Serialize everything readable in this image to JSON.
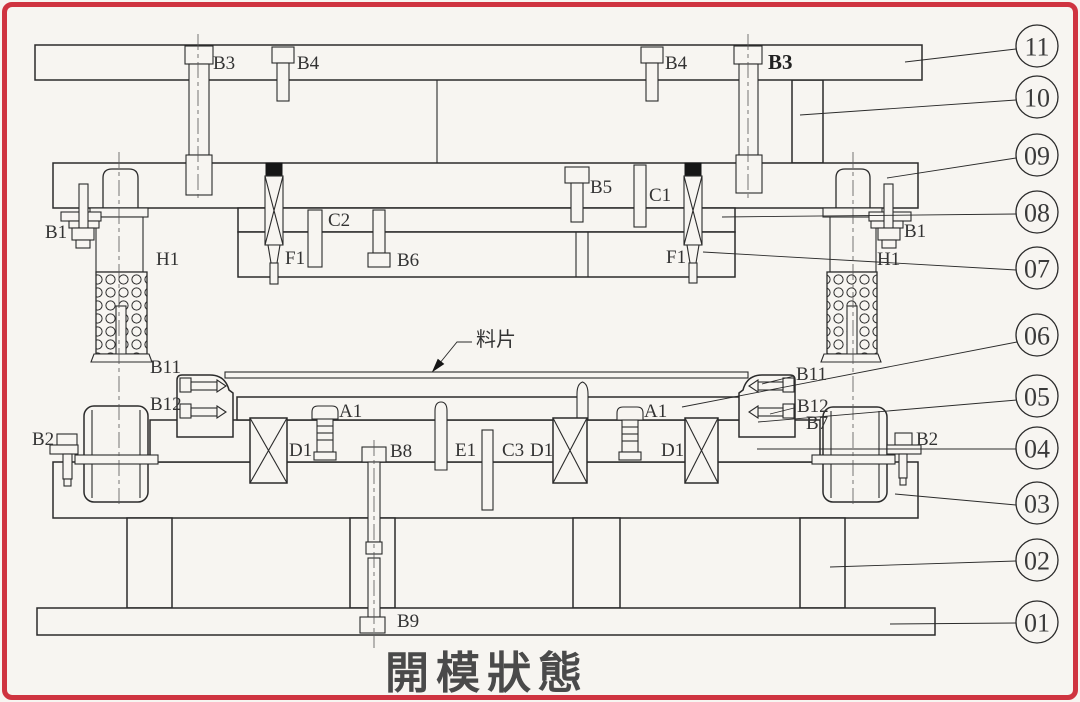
{
  "title": "開模狀態",
  "strip_label": "料片",
  "colors": {
    "border": "#cf3440",
    "paper": "#f7f5f1",
    "line": "#2b2b2b"
  },
  "balloons": [
    {
      "num": "11"
    },
    {
      "num": "10"
    },
    {
      "num": "09"
    },
    {
      "num": "08"
    },
    {
      "num": "07"
    },
    {
      "num": "06"
    },
    {
      "num": "05"
    },
    {
      "num": "04"
    },
    {
      "num": "03"
    },
    {
      "num": "02"
    },
    {
      "num": "01"
    }
  ],
  "labels": {
    "b3_left": "B3",
    "b4_left": "B4",
    "b4_right": "B4",
    "b3_right": "B3",
    "b5": "B5",
    "c1": "C1",
    "c2": "C2",
    "b6": "B6",
    "f1_left": "F1",
    "f1_right": "F1",
    "b1_left": "B1",
    "b1_right": "B1",
    "h1_left": "H1",
    "h1_right": "H1",
    "b11_left": "B11",
    "b12_left": "B12",
    "b11_right": "B11",
    "b12_right": "B12",
    "b7": "B7",
    "b2_left": "B2",
    "b2_right": "B2",
    "a1_left": "A1",
    "a1_right": "A1",
    "d1_left": "D1",
    "d1_mid": "D1",
    "d1_right": "D1",
    "b8": "B8",
    "e1": "E1",
    "c3": "C3",
    "b9": "B9"
  }
}
